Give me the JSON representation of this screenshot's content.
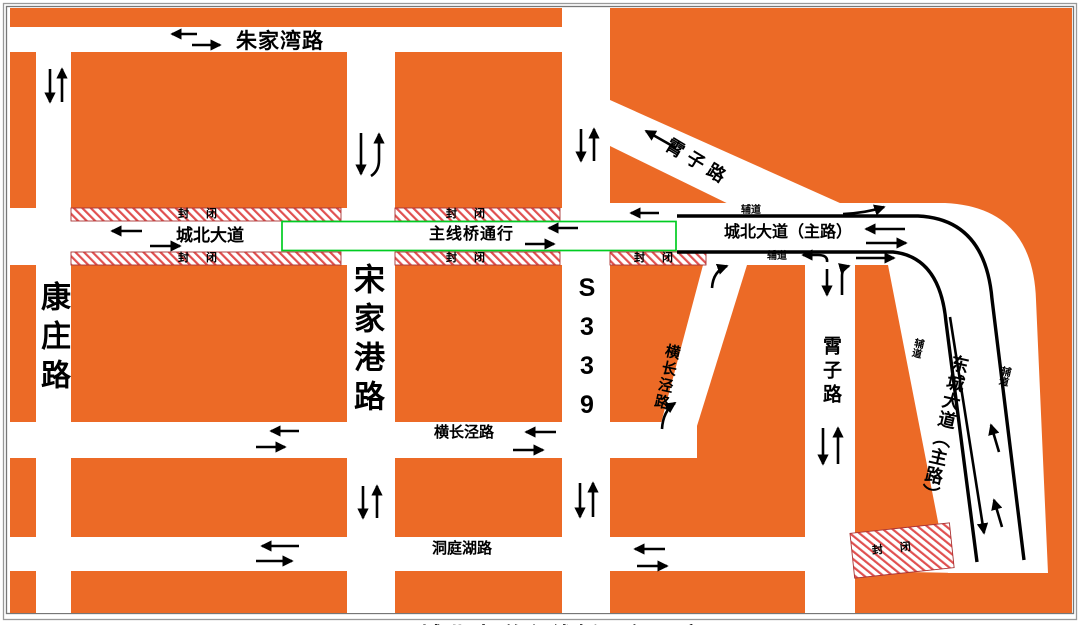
{
  "roads": {
    "zhujiawan": "朱家湾路",
    "kangzhuang": "康庄路",
    "songjiagang": "宋家港路",
    "s339": "S339",
    "chengbei": "城北大道",
    "mainline_bridge": "主线桥通行",
    "chengbei_main": "城北大道（主路）",
    "xiaozi": "霄子路",
    "hengchangjing": "横长泾路",
    "dongtinghu": "洞庭湖路",
    "dongcheng_main": "东城大道（主路）",
    "fudao": "辅道",
    "fengbi": "封 闭"
  },
  "caption_partial": "城北大道主线桥通行示意图",
  "colors": {
    "block_orange": "#EC6A26",
    "closure_hatch_red": "#E05050",
    "bridge_green": "#00CC22",
    "road_line_black": "#000000",
    "frame_gray": "#888888"
  }
}
